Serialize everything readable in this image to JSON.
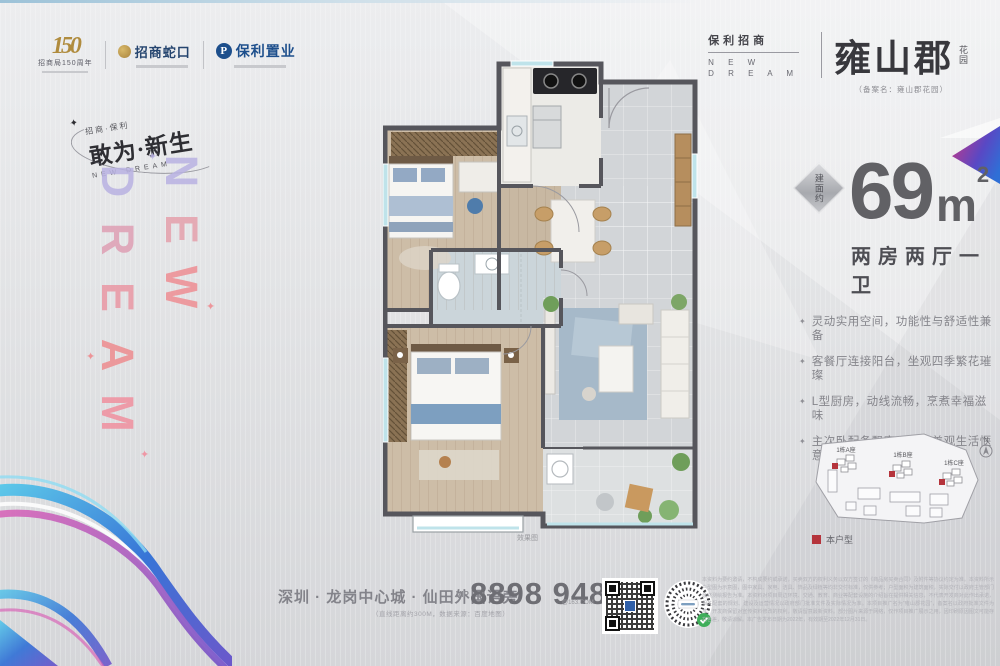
{
  "colors": {
    "accent_red": "#b5343c",
    "wall": "#56565c",
    "wood_floor": "#cdbda7",
    "tile_floor": "#d2d5d8",
    "brand_dark": "#38383d"
  },
  "top_logos": {
    "anniversary": {
      "number": "150",
      "label": "招商局150周年"
    },
    "shekou": {
      "name": "招商蛇口"
    },
    "poly": {
      "name": "保利置业",
      "initial": "P"
    }
  },
  "slogan": {
    "small_top": "招商·保利",
    "main": "敢为·新生",
    "small_bottom": "NEW DREAM"
  },
  "vertical_letters": {
    "new": "NEW",
    "dream": "DREAM",
    "new_colors": [
      "#b9b2e2",
      "#e5a0ac",
      "#ee8e93"
    ],
    "dream_colors": [
      "#b9b2e2",
      "#df9fb4",
      "#ea97a4",
      "#ee8c8f",
      "#f0909f"
    ]
  },
  "brand": {
    "pre": "保利招商",
    "nd_line1": "N E W",
    "nd_line2": "D R E A M",
    "name": "雍山郡",
    "suffix": "花园",
    "filing": "（备案名：雍山郡花园）"
  },
  "area": {
    "badge": "建面约",
    "value": "69",
    "unit": "m",
    "sup": "2",
    "rooms": "两房两厅一卫"
  },
  "features": [
    "灵动实用空间，功能性与舒适性兼备",
    "客餐厅连接阳台，坐观四季繁花璀璨",
    "L型厨房，动线流畅，烹煮幸福滋味",
    "主次卧配备飘窗，实用美观生活惬意"
  ],
  "floorplan": {
    "caption": "效果图"
  },
  "siteplan": {
    "buildings": [
      "1栋A座",
      "1栋B座",
      "1栋C座"
    ],
    "north_label": "N",
    "legend_label": "本户型"
  },
  "footer": {
    "address": "深圳 · 龙岗中心城 · 仙田外国语旁",
    "address_note": "（直线距离约300M，数据来源：百度地图）",
    "vip_label": "VIP",
    "phone": "8898 9488",
    "phone_suffix": "@163.COM"
  },
  "disclaimer": "本资料为要约邀请，不构成要约或承诺，买卖双方的权利义务以双方签订的《商品房买卖合同》及附件等协议约定为准。本资料所示户型图为示意图，图中家具、家电、洁具、饰品及绿植等均非交付标准，仅供参考；户型面积为建筑面积，实际交付以政府主管部门最终测绘报告为准。本资料对项目周边环境、交通、教育、商业等配套设施的介绍旨在提供相关信息，不代表开发商对此作出承诺，相关配套的规划、建设及运营情况以政府部门批准文件及实际情况为准。本项目推广名为“雍山郡花园”，备案名以政府批准文件为准。开发商保留对宣传资料修改的权利，敬请留意最新资料。部分图片来源于网络，仅作项目推广展示之用，因印刷原因图文可能存在色差，敬请谅解。本广告发布日期为2022年，有效期至2022年12月31日。"
}
